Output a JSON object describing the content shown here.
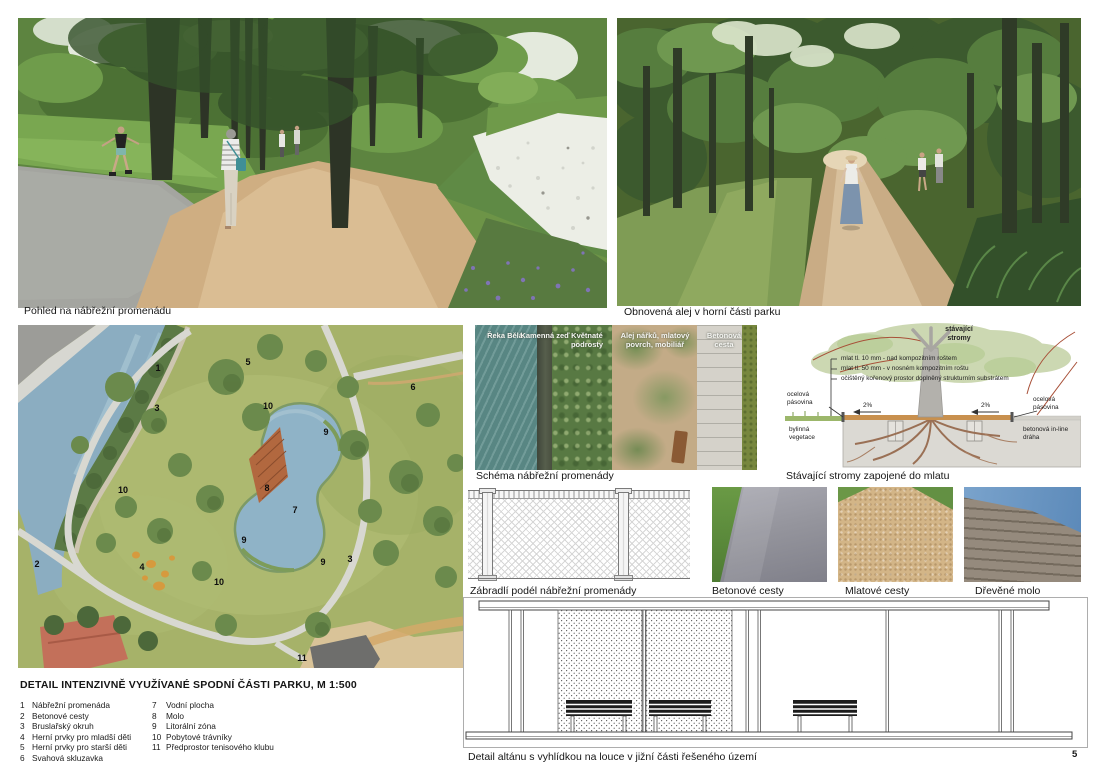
{
  "page": {
    "number": "5"
  },
  "captions": {
    "photo_promenade": "Pohled na nábřežní promenádu",
    "photo_alley": "Obnovená alej v horní části parku",
    "scheme": "Schéma nábřežní promenády",
    "tree_detail": "Stávající stromy zapojené do mlatu",
    "railing": "Zábradlí podél nábřežní promenády",
    "photo_concrete": "Betonové cesty",
    "photo_mlat": "Mlatové cesty",
    "photo_pier": "Dřevěné molo",
    "pavilion": "Detail altánu s vyhlídkou na louce v jižní části řešeného území"
  },
  "scheme_labels": [
    "Řeka Bělá",
    "Kamenná zeď",
    "Květnaté podrosty",
    "Alej nářků, mlatový povrch, mobiliář",
    "Betonová cesta"
  ],
  "tree_detail": {
    "trees_label": "stávající stromy",
    "annotations": [
      "mlat tl. 10 mm - nad kompozitním roštem",
      "mlat tl. 50 mm - v nosném kompozitním roštu",
      "očištěný kořenový prostor doplněný strukturním substrátem"
    ],
    "left_top": "ocelová pásovina",
    "left_bottom": "bylinná vegetace",
    "right_top": "ocelová pásovina",
    "right_bottom": "betonová in-line dráha",
    "slope_left": "2%",
    "slope_right": "2%"
  },
  "plan": {
    "title": "DETAIL INTENZIVNĚ VYUŽÍVANÉ SPODNÍ ČÁSTI PARKU, M 1:500",
    "markers": [
      "1",
      "3",
      "5",
      "10",
      "6",
      "9",
      "8",
      "7",
      "10",
      "9",
      "9",
      "3",
      "2",
      "4",
      "10",
      "11"
    ],
    "legend_col1": [
      {
        "num": "1",
        "label": "Nábřežní promenáda"
      },
      {
        "num": "2",
        "label": "Betonové cesty"
      },
      {
        "num": "3",
        "label": "Bruslařský okruh"
      },
      {
        "num": "4",
        "label": "Herní prvky pro mladší děti"
      },
      {
        "num": "5",
        "label": "Herní prvky pro starší děti"
      },
      {
        "num": "6",
        "label": "Svahová skluzavka"
      }
    ],
    "legend_col2": [
      {
        "num": "7",
        "label": "Vodní plocha"
      },
      {
        "num": "8",
        "label": "Molo"
      },
      {
        "num": "9",
        "label": "Litorální zóna"
      },
      {
        "num": "10",
        "label": "Pobytové trávníky"
      },
      {
        "num": "11",
        "label": "Předprostor tenisového klubu"
      }
    ]
  }
}
